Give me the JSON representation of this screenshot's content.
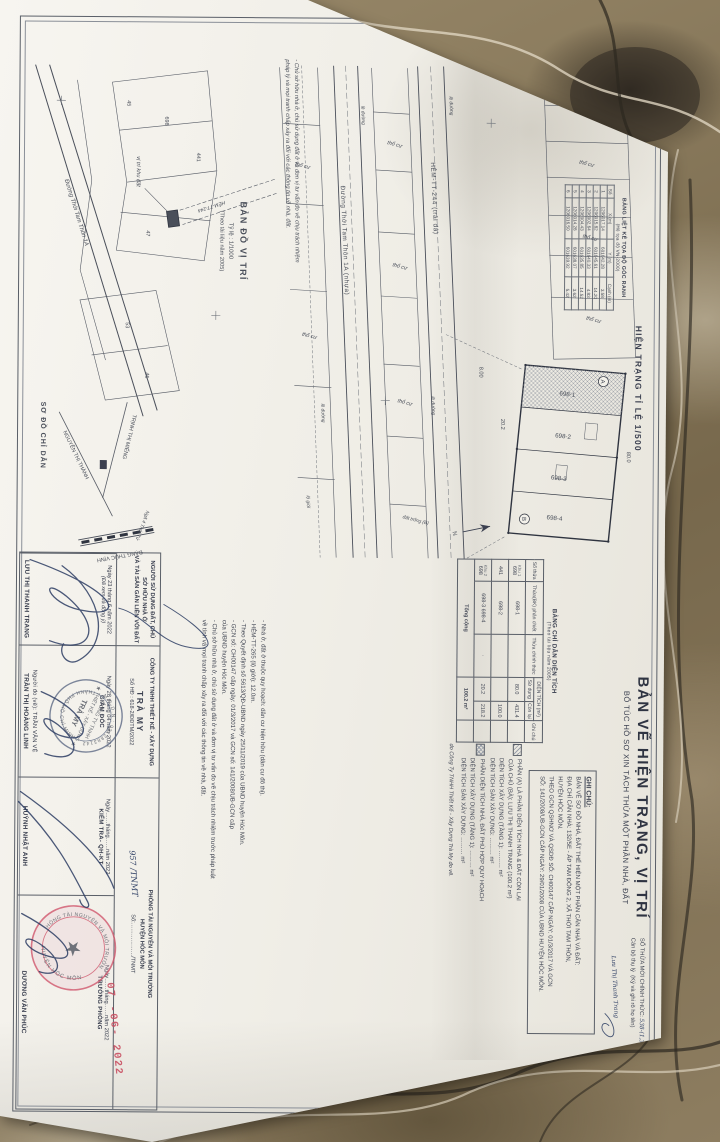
{
  "colors": {
    "paper": "#f3f1ea",
    "ink": "#3b4050",
    "line": "#5a5f68",
    "stamp_red": "#c94f62",
    "seal_ink": "#5d6a85",
    "pencil": "#979c9f",
    "marble_base": "#8d7c60"
  },
  "header": {
    "title": "BẢN VẼ HIỆN TRẠNG, VỊ TRÍ",
    "subtitle": "BỔ TÚC HỒ SƠ XIN TÁCH THỬA MỘT PHẦN NHÀ, ĐẤT",
    "drawing_heading": "HIỆN TRẠNG TỈ LỆ 1/500"
  },
  "so_thua_moi": {
    "label": "SỐ THỬA MỚI CHÍNH THỨC:",
    "value": "538-(1,3,4,5,6,7) (TB09)/2022",
    "clerk": "Cán bộ thụ lý",
    "sign_note": "(Ký và ghi rõ họ tên)",
    "clerk_hand": "Lưu Thị Thanh Trang"
  },
  "coord_table": {
    "title": "BẢNG LIỆT KÊ TỌA ĐỘ GÓC RANH",
    "subtitle": "(Hệ tọa độ VN-2000)",
    "headers": [
      "Số",
      "X (m)",
      "Y (m)",
      "Cạnh (m)"
    ],
    "rows": [
      [
        "1",
        "1206017.14",
        "601642.28",
        "3.58"
      ],
      [
        "2",
        "1206015.82",
        "601645.61",
        "14.20"
      ],
      [
        "3",
        "1206002.64",
        "601640.33",
        "4.83"
      ],
      [
        "4",
        "1206004.43",
        "601635.85",
        "14.52"
      ],
      [
        "5",
        "1206014.28",
        "601638.07",
        "3.62"
      ],
      [
        "6",
        "1206016.50",
        "601639.92",
        "5.42"
      ]
    ]
  },
  "ghi_chu": {
    "title": "GHI CHÚ:",
    "lines": [
      "BẢN VẼ SƠ ĐỒ NHÀ, ĐẤT THỂ HIỆN MỘT PHẦN CĂN NHÀ VÀ ĐẤT:",
      "ĐỊA CHỈ CĂN NHÀ: 132/5E - ẤP TAM ĐÔNG 2, XÃ THỚI TAM THÔN,",
      "HUYỆN HÓC MÔN.",
      "THEO GCN QSHNƠ VÀ QSDĐ SỐ: CH00147 CẤP NGÀY: 01/3/2017 VÀ GCN",
      "SỐ: 141/2008/UB-GCN CẤP NGÀY: 29/01/2008 CỦA UBND HUYỆN HÓC MÔN."
    ]
  },
  "legend": {
    "a1": "PHẦN (A) LÀ PHẦN DIỆN TÍCH NHÀ & ĐẤT CÒN LẠI",
    "a2": "CỦA CHỦ (BÀ): LƯU THỊ THANH TRANG (100.2 m²)",
    "xd1_label": "DIỆN TÍCH XÂY DỰNG (TẦNG 1): ……… m²",
    "san1_label": "DIỆN TÍCH SÀN XÂY DỰNG: ……… m²",
    "b1": "PHẦN DIỆN TÍCH NHÀ, ĐẤT PHÙ HỢP QUY HOẠCH",
    "xd2_label": "DIỆN TÍCH XÂY DỰNG (TẦNG 1): ……… m²",
    "san2_label": "DIỆN TÍCH SÀN XÂY DỰNG: ……… m²",
    "note": "do Công Ty TNHH Thiết Kế - Xây Dựng Trà My đo vẽ."
  },
  "area_table": {
    "title": "BẢNG CHỈ DẪN DIỆN TÍCH",
    "subtitle": "(Theo tài liệu năm 2005)",
    "h_so_thua": "Số thửa",
    "h_phan_chiet": "Thửa(BK) phân chiết",
    "h_chinh_thuc": "Thửa chính thức",
    "h_dien_tich": "DIỆN TÍCH (m²)",
    "h_su_dung": "Sử dụng",
    "h_con_lai": "Còn lại",
    "h_ghi_chu": "Ghi chú",
    "rows": [
      {
        "khu": "Khu 1",
        "so_thua": "698",
        "phan_chiet": "698-1",
        "chinh_thuc": "",
        "su_dung": "80.0",
        "con_lai": "431.4",
        "ghi_chu": ""
      },
      {
        "khu": "",
        "so_thua": "441",
        "phan_chiet": "698-2",
        "chinh_thuc": "",
        "su_dung": "",
        "con_lai": "100.0",
        "ghi_chu": ""
      },
      {
        "khu": "Khu 2",
        "so_thua": "698",
        "phan_chiet": "698-3  698-4",
        "chinh_thuc": "·",
        "su_dung": "20.2",
        "con_lai": "218.2",
        "ghi_chu": ""
      }
    ],
    "total_label": "Tổng cộng",
    "total_value": "100.2 m²"
  },
  "main_drawing": {
    "road1": "HẺM-TT-244 (trải đá)",
    "road2": "Đường Thới Tam Thôn 1A (nhựa)",
    "tho_cu": "thổ cư",
    "le_duong": "lề đường",
    "lo_gioi": "lộ giới",
    "dat_trong": "đất trống (B)",
    "p1": "698-1",
    "p2": "698-2",
    "p3": "698-3",
    "p4": "698-4",
    "marker_a": "A",
    "marker_b": "B",
    "dim1": "80.0",
    "dim2": "20.2",
    "dim3": "8.00",
    "north": "N"
  },
  "vi_tri_map": {
    "title": "BẢN ĐỒ VỊ TRÍ",
    "scale": "Tỷ lệ : 1/1000",
    "source": "(Theo tài liệu năm 2005)",
    "site_label": "vị trí khu đất",
    "road1": "Đường Thới Tam Thôn 1A",
    "road2": "HẺM-TT-244",
    "n698": "698",
    "n441": "441",
    "n45": "45",
    "n47": "47",
    "n53": "53",
    "n46": "46"
  },
  "chi_dan_map": {
    "title": "SƠ ĐỒ CHỈ DẪN",
    "s1": "TRỊNH THỊ MIẾNG",
    "s2": "NGUYỄN THỊ THÀNH",
    "s3": "ĐẶNG THÚC VỊNH",
    "junction": "Ngã 4 Thới Tứ"
  },
  "disclaimer": {
    "line1": "- Chủ sở hữu nhà ở, chủ sử dụng đất ở và đơn vị tư vấn đo vẽ chịu trách nhiệm",
    "line2": "pháp lý và mọi tranh chấp xảy ra đối với các thông tin về nhà, đất."
  },
  "notes": {
    "lines": [
      "- Nhà ở, đất ở thuộc quy hoạch: dân cư hiện hữu (dân cư đô thị).",
      "- HẺM-TT-265 (lộ giới): 12.0m.",
      "- Theo Quyết định số 5613/QĐ-UBND ngày 25/11/2019 của UBND huyện Hóc Môn.",
      "- GCN số: CH00147 cấp ngày: 01/3/2017 và GCN số: 141/2008/UB-GCN cấp",
      "  của UBND huyện Hóc Môn.",
      "- Chủ sở hữu nhà ở, chủ sử dụng đất ở và đơn vị tư vấn đo vẽ chịu trách nhiệm trước pháp luật",
      "  về tính và mọi tranh chấp xảy ra đối với các thông tin về nhà, đất."
    ]
  },
  "signature_block": {
    "col1_h1": "NGƯỜI SỬ DỤNG ĐẤT, CHỦ SỞ HỮU NHÀ Ở",
    "col1_h2": "VÀ TÀI SẢN GẮN LIỀN VỚI ĐẤT",
    "col2_h1": "CÔNG TY TNHH THIẾT KẾ - XÂY DỰNG",
    "col2_h2": "TRÀ MY",
    "col2_h3": "Số HĐ : 618-2/ĐĐTM/2022",
    "col3_h1": "PHÒNG TÀI NGUYÊN VÀ MÔI TRƯỜNG",
    "col3_h2": "HUYỆN HÓC MÔN",
    "col3_h3": "Số:………………/TNMT",
    "col1_date": "Ngày 23 tháng 6 năm 2022",
    "col1_note": "(Đã xem và đồng ý)",
    "col1_name": "LƯU THỊ THANH TRANG",
    "nguoi_do_ve": "Người đo (vẽ):  TRẦN VĂN VỆ",
    "col2_date": "Ngày 28 tháng 04 năm 2022",
    "col2_role": "GIÁM ĐỐC",
    "col2_name": "TRẦN THỊ HOÀNG LINH",
    "col3a_date": "Ngày……tháng……năm 2022",
    "col3a_role": "KIỂM TRA- QH-KT",
    "col3a_name": "HUỲNH NHẬT ANH",
    "col3b_date": "Ngày……tháng……năm 2022",
    "col3b_role": "TRƯỞNG PHÒNG",
    "col3b_name": "DƯƠNG VĂN PHÚC"
  },
  "seals": {
    "company": {
      "ring_top": "M.S.D.N : 0312883142",
      "ring_bottom": "THÀNH PHỐ HỒ CHÍ MINH",
      "line1": "CÔNG TY TNHH",
      "line2": "THIẾT KẾ - XÂY DỰNG",
      "line3": "TRÀ MY"
    },
    "dept": {
      "ring_top": "PHÒNG TÀI NGUYÊN VÀ MÔI TRƯỜNG",
      "ring_bottom": "HUYỆN HÓC MÔN",
      "center": "★"
    }
  },
  "stamps": {
    "date": "07 -06- 2022",
    "so_tnmt": "957 /TNMT"
  }
}
